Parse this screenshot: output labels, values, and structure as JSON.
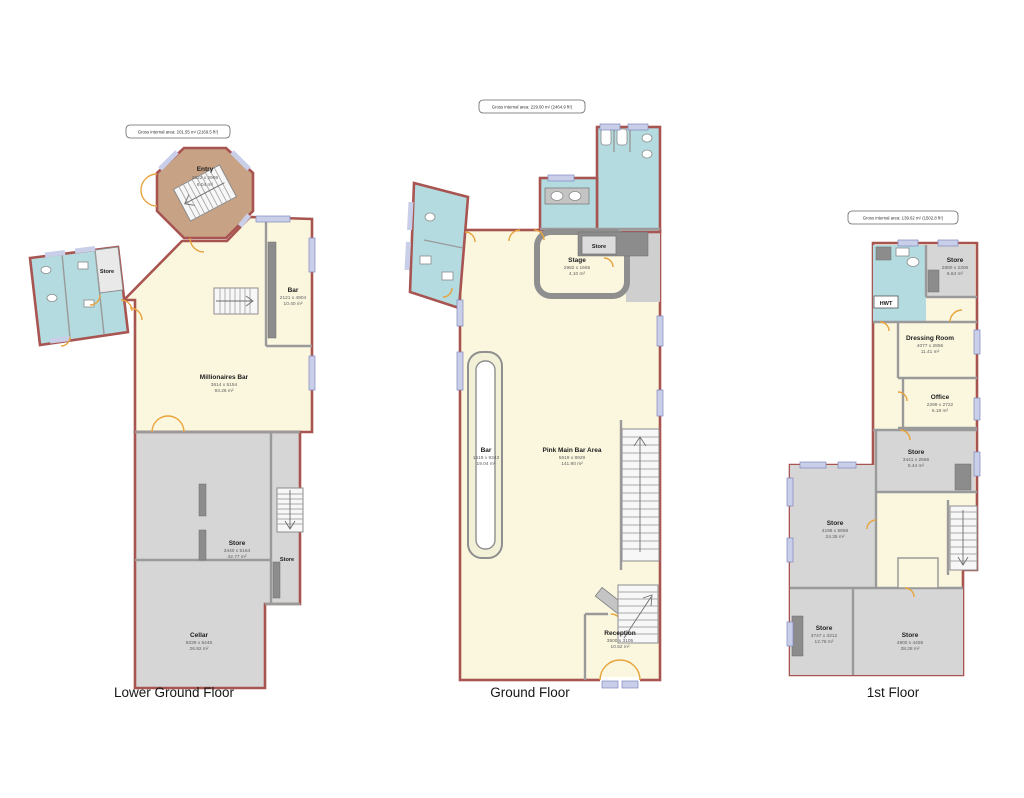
{
  "document": {
    "type": "floorplan",
    "background": "#ffffff"
  },
  "colors": {
    "cream": "#FBF7DF",
    "gray": "#D6D6D6",
    "teal": "#B4DBE0",
    "tan": "#C8A284",
    "wall_red": "#A85552",
    "wall_gray": "#9A9A9A",
    "window_blue": "#C9CEE9",
    "door_orange": "#E8A33D",
    "dark_fixture": "#8C8C8C"
  },
  "floors": [
    {
      "title": "Lower Ground Floor",
      "gross_area": "Gross internal area: 201.55 m² (2169.5 ft²)",
      "rooms": [
        {
          "name": "Entry",
          "dims": "2522 x 2995",
          "area": "6.04 m²"
        },
        {
          "name": "Store",
          "dims": "",
          "area": ""
        },
        {
          "name": "Bar",
          "dims": "2121 x 4904",
          "area": "10.40 m²"
        },
        {
          "name": "Millionaires Bar",
          "dims": "3614 x 5154",
          "area": "93.26 m²"
        },
        {
          "name": "Store",
          "dims": "3440 x 5164",
          "area": "42.77 m²"
        },
        {
          "name": "Store",
          "dims": "",
          "area": ""
        },
        {
          "name": "Cellar",
          "dims": "5039 x 5446",
          "area": "26.92 m²"
        }
      ]
    },
    {
      "title": "Ground Floor",
      "gross_area": "Gross internal area: 229.00 m² (2464.9 ft²)",
      "rooms": [
        {
          "name": "Store",
          "dims": "",
          "area": ""
        },
        {
          "name": "Stage",
          "dims": "2982 x 1665",
          "area": "4.10 m²"
        },
        {
          "name": "Bar",
          "dims": "1519 x 9343",
          "area": "19.04 m²"
        },
        {
          "name": "Pink Main Bar Area",
          "dims": "5619 x 8929",
          "area": "141.90 m²"
        },
        {
          "name": "Reception",
          "dims": "3500 x 3105",
          "area": "10.52 m²"
        }
      ]
    },
    {
      "title": "1st Floor",
      "gross_area": "Gross internal area: 139.62 m² (1502.8 ft²)",
      "rooms": [
        {
          "name": "Store",
          "dims": "2880 x 2306",
          "area": "6.64 m²"
        },
        {
          "name": "HWT",
          "dims": "",
          "area": ""
        },
        {
          "name": "Dressing Room",
          "dims": "4077 x 2856",
          "area": "11.41 m²"
        },
        {
          "name": "Office",
          "dims": "2299 x 2722",
          "area": "6.18 m²"
        },
        {
          "name": "Store",
          "dims": "3441 x 2566",
          "area": "8.44 m²"
        },
        {
          "name": "Store",
          "dims": "4196 x 5868",
          "area": "24.35 m²"
        },
        {
          "name": "Store",
          "dims": "3747 x 3312",
          "area": "12.78 m²"
        },
        {
          "name": "Store",
          "dims": "4900 x 4455",
          "area": "38.28 m²"
        }
      ]
    }
  ]
}
